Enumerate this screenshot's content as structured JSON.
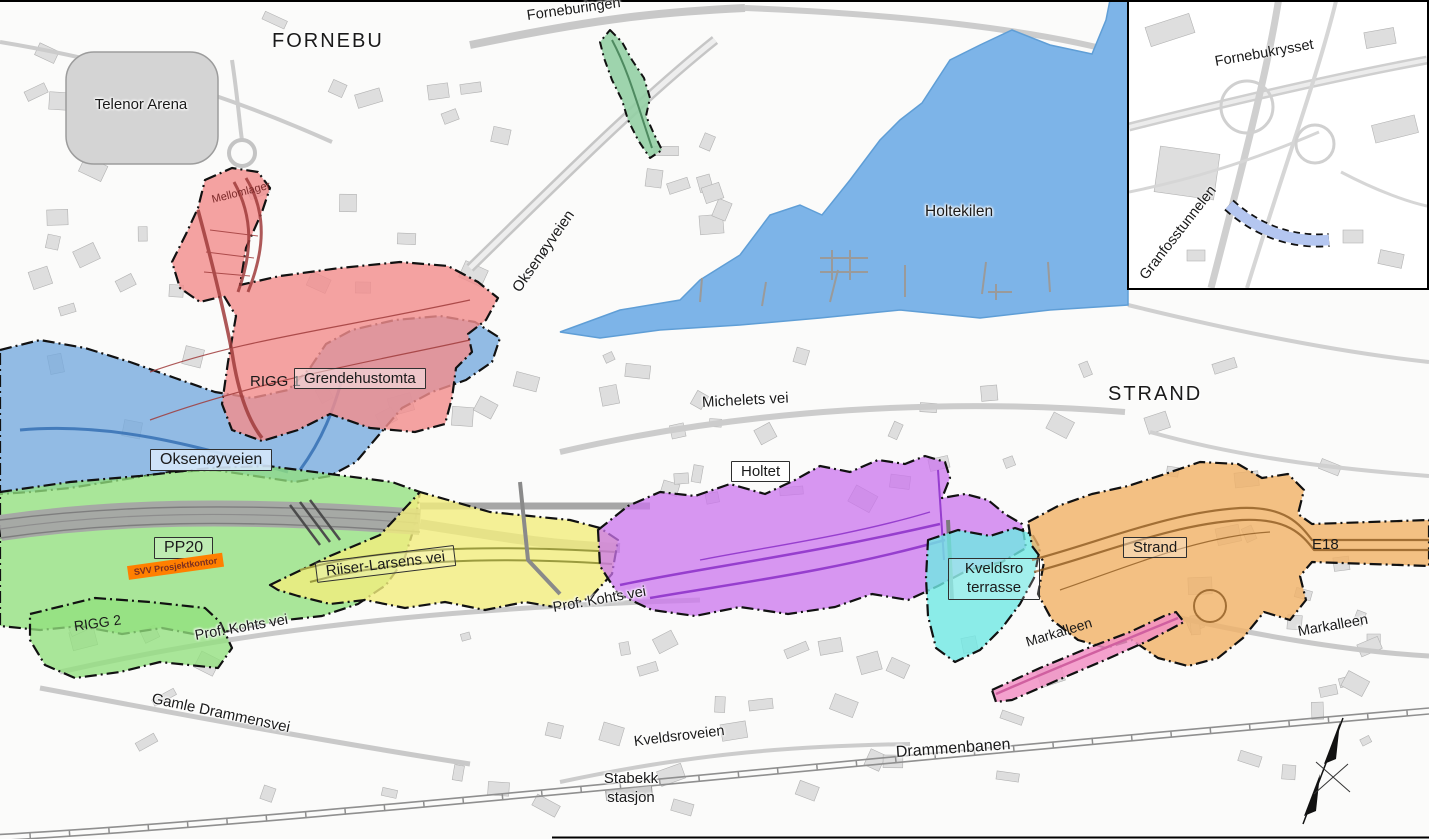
{
  "labels": {
    "fornebu": "FORNEBU",
    "telenor_arena": "Telenor Arena",
    "forneburingen": "Forneburingen",
    "oksenoyveien_road": "Oksenøyveien",
    "holtekilen": "Holtekilen",
    "strand_region": "STRAND",
    "michelets_vei": "Michelets vei",
    "mellomlager": "Mellomlager",
    "rigg_1": "RIGG 1",
    "grendehustomta": "Grendehustomta",
    "oksenoyveien_zone": "Oksenøyveien",
    "pp20": "PP20",
    "svv_prosjektkontor": "SVV Prosjektkontor",
    "rigg_2": "RIGG 2",
    "riiser_larsens_vei": "Riiser-Larsens vei",
    "prof_kohts_vei_west": "Prof. Kohts vei",
    "prof_kohts_vei_east": "Prof. Kohts vei",
    "holtet": "Holtet",
    "kveldsro_terrasse": "Kveldsro terrasse",
    "strand_zone": "Strand",
    "e18": "E18",
    "markalleen_zone": "Markalleen",
    "markalleen_east": "Markalleen",
    "gamle_drammensvei": "Gamle Drammensvei",
    "kveldsroveien": "Kveldsroveien",
    "drammenbanen": "Drammenbanen",
    "stabekk_stasjon": "Stabekk stasjon",
    "fornebukrysset": "Fornebukrysset",
    "granfosstunnelen": "Granfosstunnelen"
  },
  "colors": {
    "water": "#7db4e8",
    "water_edge": "#5f9ed6",
    "zone_red": "#f18d8d",
    "zone_red_road": "#a03c3c",
    "zone_blue": "#74a9de",
    "zone_blue_road": "#2f6bb0",
    "zone_green": "#92e07e",
    "zone_yellow": "#f2ee7d",
    "zone_purple": "#cb74ee",
    "zone_purple_road": "#8b2fc9",
    "zone_cyan": "#6fe8e4",
    "zone_orange": "#f0b269",
    "zone_orange_road": "#8f5c22",
    "zone_pink": "#f291c4",
    "zone_pink_road": "#d060a0",
    "zone_strip_green": "#93cfa4",
    "zone_lavender": "#b4c6f0",
    "svv_box": "#ff7f00",
    "outline": "#111111"
  }
}
